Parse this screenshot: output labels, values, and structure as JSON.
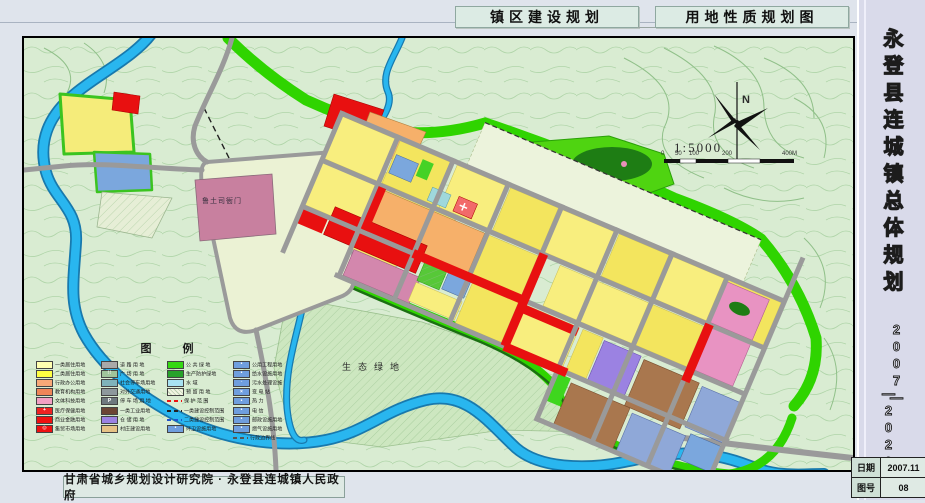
{
  "header": {
    "title_left": "镇区建设规划",
    "title_right": "用地性质规划图"
  },
  "sidebar": {
    "title": "永登县连城镇总体规划",
    "years_top": "2007—",
    "years_bottom": "—2020",
    "info": [
      {
        "label": "日期",
        "value": "2007.11"
      },
      {
        "label": "图号",
        "value": "08"
      }
    ]
  },
  "footer": {
    "credit": "甘肃省城乡规划设计研究院 · 永登县连城镇人民政府"
  },
  "map": {
    "labels": {
      "eco_green": "生态绿地",
      "heritage": "鲁土司衙门"
    },
    "compass": {
      "north": "N",
      "scale_text": "1:5000",
      "scale_ticks": [
        "0",
        "50",
        "100",
        "200",
        "400M"
      ]
    },
    "colors": {
      "residential1": "#fdf7ae",
      "residential2": "#f3e55e",
      "commercial_red": "#e81010",
      "industrial_brown": "#a9774e",
      "warehouse_purple": "#9b82e2",
      "green_public": "#35d812",
      "water": "#29b6ef",
      "utility_blue": "#6f9ede"
    },
    "legend": {
      "title": "图  例",
      "columns": [
        [
          {
            "label": "一类居住用地",
            "color": "#ffffb0",
            "kind": "fill"
          },
          {
            "label": "二类居住用地",
            "color": "#ffff42",
            "kind": "fill"
          },
          {
            "label": "行政办公用地",
            "color": "#f8a978",
            "kind": "fill"
          },
          {
            "label": "教育机构用地",
            "color": "#ef8558",
            "kind": "fill"
          },
          {
            "label": "文体科技用地",
            "color": "#f2a0c4",
            "kind": "fill"
          },
          {
            "label": "医疗保健用地",
            "color": "#ee2222",
            "kind": "icon",
            "icon": "+"
          },
          {
            "label": "商业金融用地",
            "color": "#ee1111",
            "kind": "fill"
          },
          {
            "label": "集贸市场用地",
            "color": "#ee1111",
            "kind": "icon",
            "icon": "◎"
          }
        ],
        [
          {
            "label": "道 路 用 地",
            "color": "#a9a9a9",
            "kind": "fill"
          },
          {
            "label": "广 场 用 地",
            "color": "#9fc49a",
            "kind": "icon",
            "icon": "∷"
          },
          {
            "label": "社会停车场用地",
            "color": "#7fb3ba",
            "kind": "fill"
          },
          {
            "label": "对外交通用地",
            "color": "#8d989c",
            "kind": "fill"
          },
          {
            "label": "停 车 场 用 地",
            "color": "#6e787e",
            "kind": "icon",
            "icon": "P"
          },
          {
            "label": "一类工业用地",
            "color": "#6b4434",
            "kind": "fill"
          },
          {
            "label": "仓 储 用 地",
            "color": "#9b82e2",
            "kind": "fill"
          },
          {
            "label": "村庄建设用地",
            "color": "#e6c285",
            "kind": "fill"
          }
        ],
        [
          {
            "label": "公 共 绿 地",
            "color": "#35d812",
            "kind": "fill"
          },
          {
            "label": "生产防护绿地",
            "color": "#27a22b",
            "kind": "fill"
          },
          {
            "label": "水    域",
            "color": "#a8e2f2",
            "kind": "fill"
          },
          {
            "label": "预 留 用 地",
            "color": "#f2f5e2",
            "kind": "hatch"
          },
          {
            "label": "保 护 范 围",
            "color": "#ee1111",
            "kind": "line"
          },
          {
            "label": "一类建设控制范围",
            "color": "#222222",
            "kind": "line"
          },
          {
            "label": "二类建设控制范围",
            "color": "#2255cc",
            "kind": "line"
          },
          {
            "label": "环卫设施用地",
            "color": "#6f9ede",
            "kind": "icon",
            "icon": "•"
          }
        ],
        [
          {
            "label": "公用工程用地",
            "color": "#6f9ede",
            "kind": "icon",
            "icon": "•"
          },
          {
            "label": "给水设施用地",
            "color": "#6f9ede",
            "kind": "icon",
            "icon": "•"
          },
          {
            "label": "污水处理设施",
            "color": "#6f9ede",
            "kind": "icon",
            "icon": "◦"
          },
          {
            "label": "变  电  站",
            "color": "#6f9ede",
            "kind": "icon",
            "icon": "×"
          },
          {
            "label": "热    力",
            "color": "#6f9ede",
            "kind": "icon",
            "icon": "•"
          },
          {
            "label": "电    信",
            "color": "#6f9ede",
            "kind": "icon",
            "icon": "•"
          },
          {
            "label": "邮政设施用地",
            "color": "#6f9ede",
            "kind": "icon",
            "icon": "•"
          },
          {
            "label": "燃气设施用地",
            "color": "#6f9ede",
            "kind": "icon",
            "icon": "•"
          },
          {
            "label": "行政边界线",
            "color": "#555555",
            "kind": "line"
          }
        ]
      ]
    }
  }
}
